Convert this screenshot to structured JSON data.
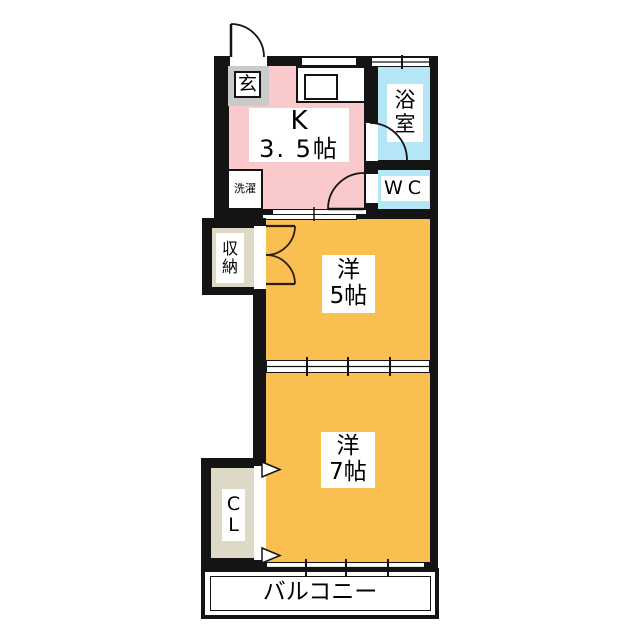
{
  "floorplan": {
    "rooms": {
      "genkan": {
        "label": "玄"
      },
      "kitchen": {
        "name_line": "K",
        "size_line": "3. 5帖"
      },
      "bath": {
        "label": "浴室"
      },
      "wc": {
        "label": "WC"
      },
      "laundry": {
        "label": "洗濯"
      },
      "storage": {
        "label": "収納"
      },
      "room5": {
        "name_line": "洋",
        "size_line": "5帖"
      },
      "room7": {
        "name_line": "洋",
        "size_line": "7帖"
      },
      "closet": {
        "line1": "C",
        "line2": "L"
      },
      "balcony": {
        "label": "バルコニー"
      }
    },
    "colors": {
      "wall": "#141414",
      "kitchen_floor": "#F9C9CB",
      "room_floor": "#F9BF50",
      "wet_area": "#B5E6F5",
      "closet_fill": "#DDD9C6",
      "genkan_fill": "#CACACA",
      "background": "#FFFFFF"
    }
  }
}
